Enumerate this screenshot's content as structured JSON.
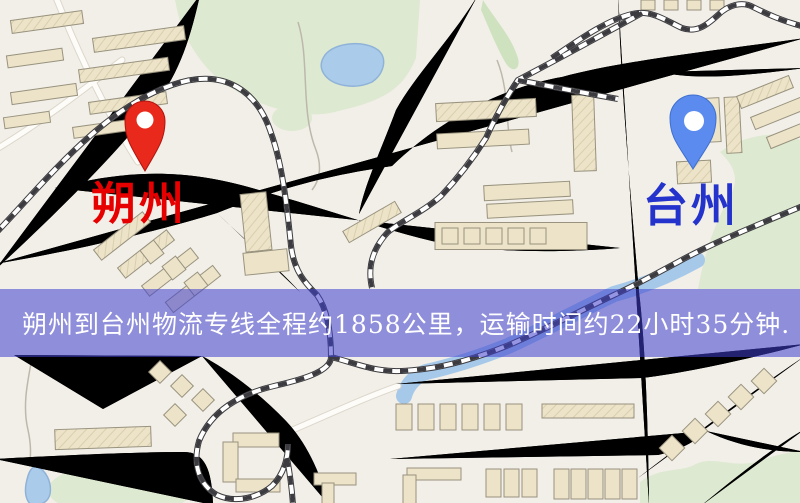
{
  "map": {
    "origin": {
      "name": "朔州",
      "pin_color": "#e8291c",
      "pin_edge_color": "#b01510",
      "label_color": "#e60000"
    },
    "destination": {
      "name": "台州",
      "pin_color": "#5b8bee",
      "pin_edge_color": "#3e6fd0",
      "label_color": "#2433cc"
    },
    "banner": {
      "text": "朔州到台州物流专线全程约1858公里，运输时间约22小时35分钟.",
      "background": "rgba(62,62,205,0.55)",
      "text_color": "#ffffff"
    },
    "route": {
      "distance": "约1858公里",
      "duration": "约22小时35分钟"
    },
    "palette": {
      "background": "#f2efe8",
      "road_yellow": "#f6d46e",
      "road_casing": "#e2b45a",
      "secondary_road": "#fdfcf8",
      "water": "#aacbea",
      "park": "#dde9d0",
      "railway": "#3c3c40",
      "building": "#ece3c8"
    }
  }
}
